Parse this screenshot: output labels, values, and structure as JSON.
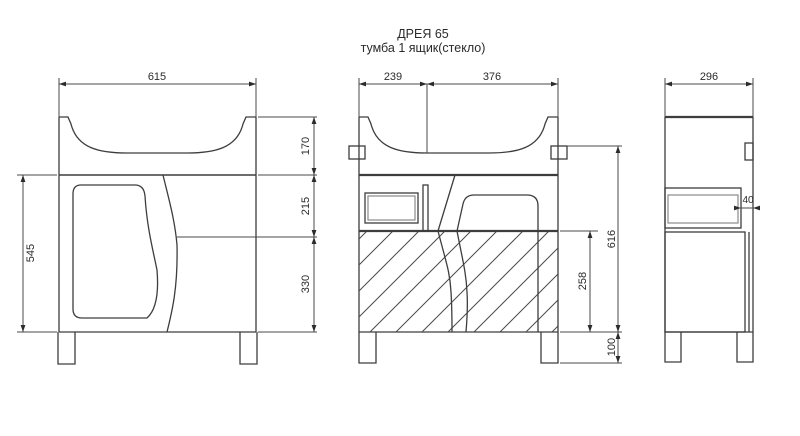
{
  "title": {
    "line1": "ДРЕЯ 65",
    "line2": "тумба 1 ящик(стекло)"
  },
  "colors": {
    "background": "#ffffff",
    "line": "#3d3d3d",
    "text": "#2b2b2b"
  },
  "dimensions": [
    {
      "id": "d615",
      "value": "615"
    },
    {
      "id": "d239",
      "value": "239"
    },
    {
      "id": "d376",
      "value": "376"
    },
    {
      "id": "d296",
      "value": "296"
    },
    {
      "id": "d170",
      "value": "170"
    },
    {
      "id": "d215",
      "value": "215"
    },
    {
      "id": "d330",
      "value": "330"
    },
    {
      "id": "d545",
      "value": "545"
    },
    {
      "id": "d616",
      "value": "616"
    },
    {
      "id": "d258",
      "value": "258"
    },
    {
      "id": "d100",
      "value": "100"
    },
    {
      "id": "d40",
      "value": "40"
    }
  ]
}
